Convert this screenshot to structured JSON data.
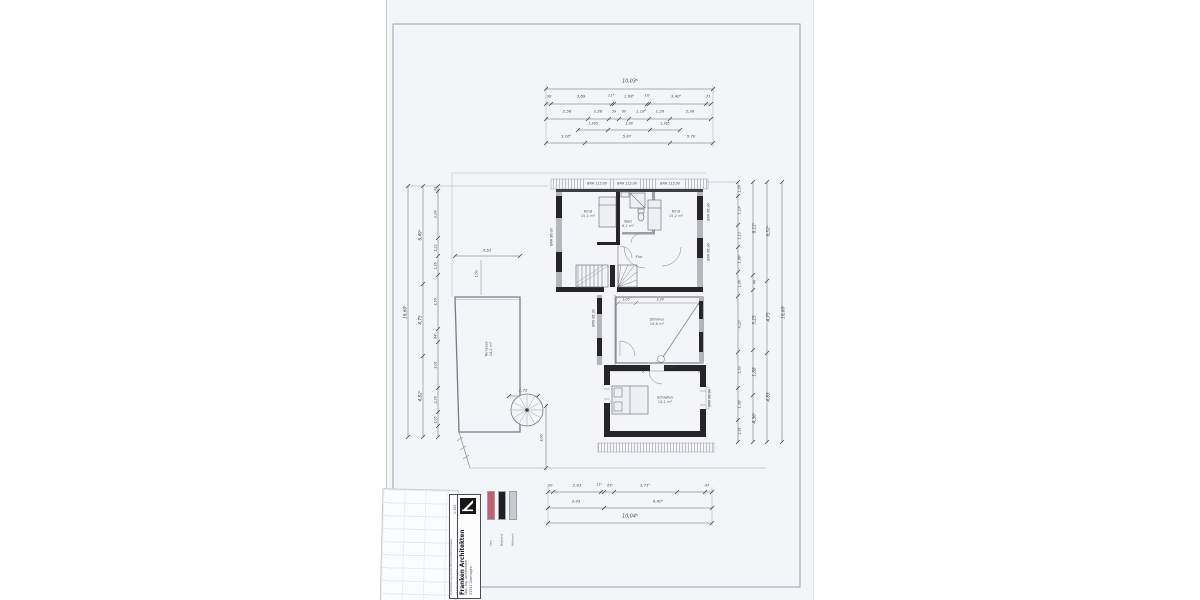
{
  "dims_top": {
    "total": "10,03⁵",
    "row1": [
      "30",
      "3,69",
      "11⁵",
      "1,99⁵",
      "10",
      "3,40⁵",
      "31"
    ],
    "row2": [
      "2,56",
      "1,26",
      "59",
      "60",
      "1,18⁵",
      "1,26",
      "2,38"
    ],
    "row2b": [
      "1,385",
      "1,38",
      "1,385"
    ],
    "row3": [
      "3,16⁵",
      "5,87",
      "3,70"
    ]
  },
  "dims_bottom": {
    "row1": [
      "20",
      "2,93",
      "11⁵",
      "63⁵",
      "3,71⁵",
      "47"
    ],
    "row2": [
      "3,43",
      "6,60⁵"
    ],
    "total": "10,04⁵"
  },
  "dims_left": {
    "total": "16,60⁵",
    "outer": [
      "6,49⁵",
      "4,75",
      "4,82⁵"
    ],
    "inner": [
      "30",
      "3,10⁵",
      "1,22",
      "1,26",
      "3,59",
      "84⁵",
      "3,01",
      "2,26",
      "1,05"
    ]
  },
  "dims_right": {
    "total": "16,60⁵",
    "outer": [
      "6,52⁵",
      "4,75",
      "4,83"
    ],
    "mid": [
      "6,12⁵",
      "40",
      "5,25",
      "1,88",
      "4,36⁵"
    ],
    "inner": [
      "1,26",
      "1,13⁵",
      "1,13",
      "1,96⁵",
      "1,26",
      "4,22⁵",
      "1,93",
      "1,38⁵",
      "1,91"
    ]
  },
  "plan": {
    "window_band": [
      "BRH 115.00",
      "BRH 115.00",
      "BRH 115.00"
    ],
    "brh": "BRH 86.00",
    "rooms": {
      "left_name": "Kind",
      "left_area": "15,1 m²",
      "bath_name": "Bad",
      "bath_area": "6,1 m²",
      "right_name": "Kind",
      "right_area": "15,2 m²",
      "hall": "Flur",
      "mid_name": "Zimmer",
      "mid_area": "14,6 m²",
      "bottom_name": "Schlafen",
      "bottom_area": "14,1 m²"
    },
    "terrace_name": "Terrasse",
    "terrace_area": "24,1 m²",
    "dim_mid_a": "1,05",
    "dim_mid_b": "3,34",
    "dim_bottom": "2,81",
    "dim_terrace_w": "3,51",
    "dim_terrace_in": "1,00",
    "dim_spiral": "1,73",
    "dim_drop": "3,00"
  },
  "titleblock": {
    "firm": "Franken Architekten",
    "sub1": "Dipl.-Ing. Architekten",
    "sub2": "41542 Dormagen",
    "project1": "Aufstockung eines Einfamilienhauses",
    "project2": "41542 Dormagen",
    "scale": "1:100"
  },
  "legend": {
    "items": [
      {
        "label": "neu",
        "color": "#bb6373"
      },
      {
        "label": "Bestand",
        "color": "#202024"
      },
      {
        "label": "Abbruch",
        "color": "#c8cacf"
      }
    ]
  }
}
